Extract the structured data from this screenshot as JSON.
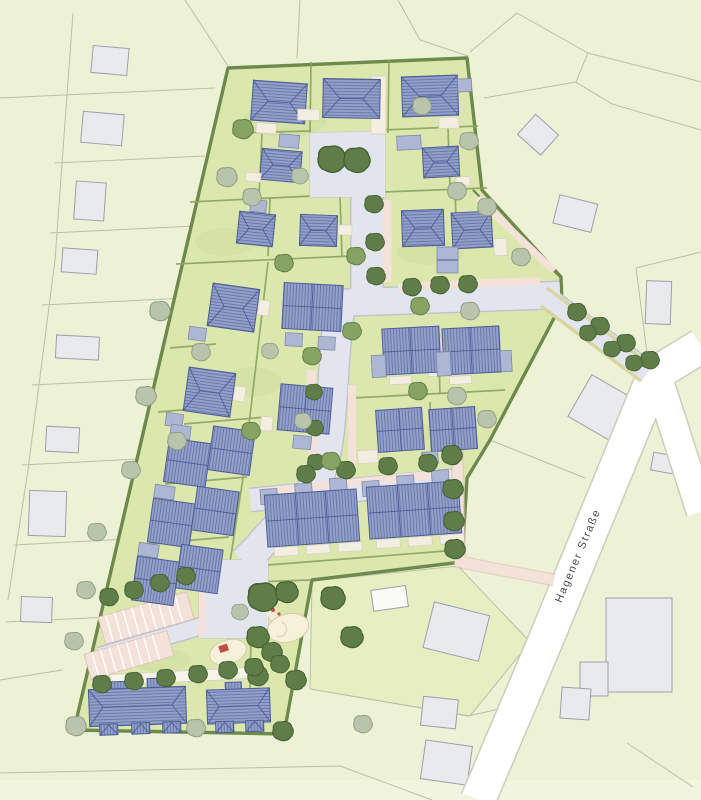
{
  "labels": {
    "street": "Hagener Straße"
  },
  "palette": {
    "surround": "#edf2d6",
    "bottom_strip": "#f1f4de",
    "lawn": "#e6eec2",
    "site": "#dce7ae",
    "site_tex": "#c9d894",
    "hedge": "#6d8a4c",
    "hedge2": "#8aa45e",
    "parcel": "#b8c1a4",
    "road": "#e3e5ee",
    "road_edge": "#c0c4d0",
    "hagener": "#ffffff",
    "hagener_edge": "#cbcebb",
    "drive": "#f4e2da",
    "drive_edge": "#dcc0b4",
    "roof": "#93a1c9",
    "roof_hatch": "#5e6fa5",
    "roof_line": "#4d5d95",
    "garage": "#adb7d3",
    "garage_edge": "#7e8aae",
    "terrace": "#f3eee2",
    "terrace_edge": "#d7cfba",
    "exist": "#e9eaee",
    "exist_edge": "#9aa1ab",
    "shed": "#fbfbf6",
    "path_white": "#f7f4ea",
    "sand": "#f7f0da",
    "sand_edge": "#d9caa4",
    "red": "#bf5048",
    "tree_dark": "#5f7d49",
    "tree_dark_edge": "#40602f",
    "tree_mid": "#86a364",
    "tree_mid_edge": "#5d7b45",
    "tree_gray": "#b8c4ab",
    "tree_gray_edge": "#8e9b81",
    "label": "#46494d"
  }
}
